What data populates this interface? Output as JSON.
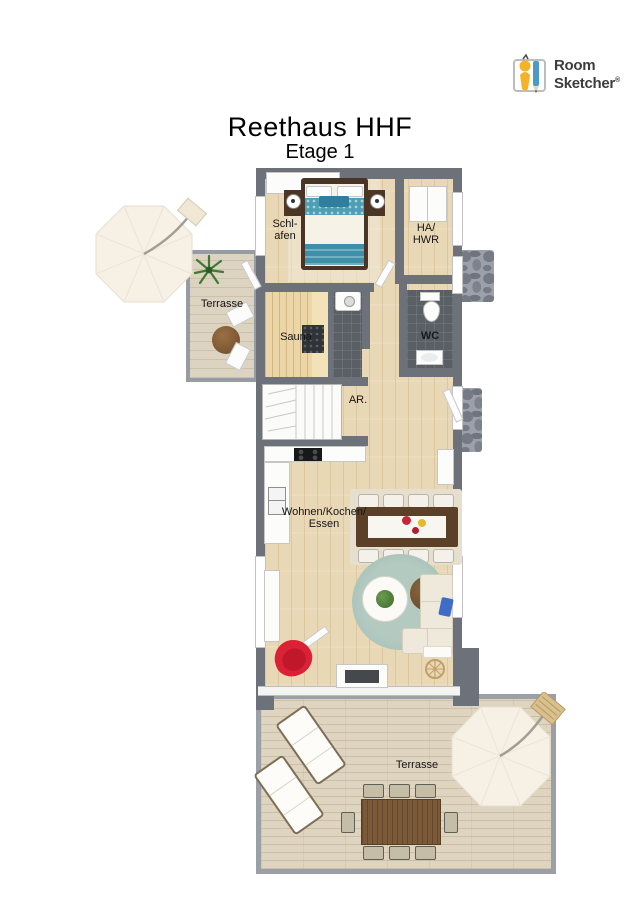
{
  "logo": {
    "line1": "Room",
    "line2": "Sketcher",
    "registered": "®"
  },
  "header": {
    "title": "Reethaus HHF",
    "subtitle": "Etage 1"
  },
  "rooms": {
    "bedroom": {
      "label": "Schl-\nafen"
    },
    "utility": {
      "label": "HA/\nHWR"
    },
    "terrace_upper": {
      "label": "Terrasse"
    },
    "sauna": {
      "label": "Sauna"
    },
    "wc": {
      "label": "WC"
    },
    "hall": {
      "label": "AR."
    },
    "living": {
      "label": "Wohnen/Kochen/\nEssen"
    },
    "terrace_lower": {
      "label": "Terrasse"
    }
  },
  "colors": {
    "wall": "#6d727a",
    "wood_floor": "#e9d8b6",
    "deck": "#ded4bf",
    "upper_terrace": "#dcd3c0",
    "sauna_wood": "#ecd5a6",
    "wet_room_tile": "#5a5f66",
    "living_rug": "#aac4ba",
    "bed_accent_teal": "#4d9fb6",
    "armchair_red": "#da2136",
    "outdoor_table_wood": "#7b5a39",
    "flagstone": "#9ba0a9",
    "umbrella_canvas": "#f7f0e5"
  }
}
